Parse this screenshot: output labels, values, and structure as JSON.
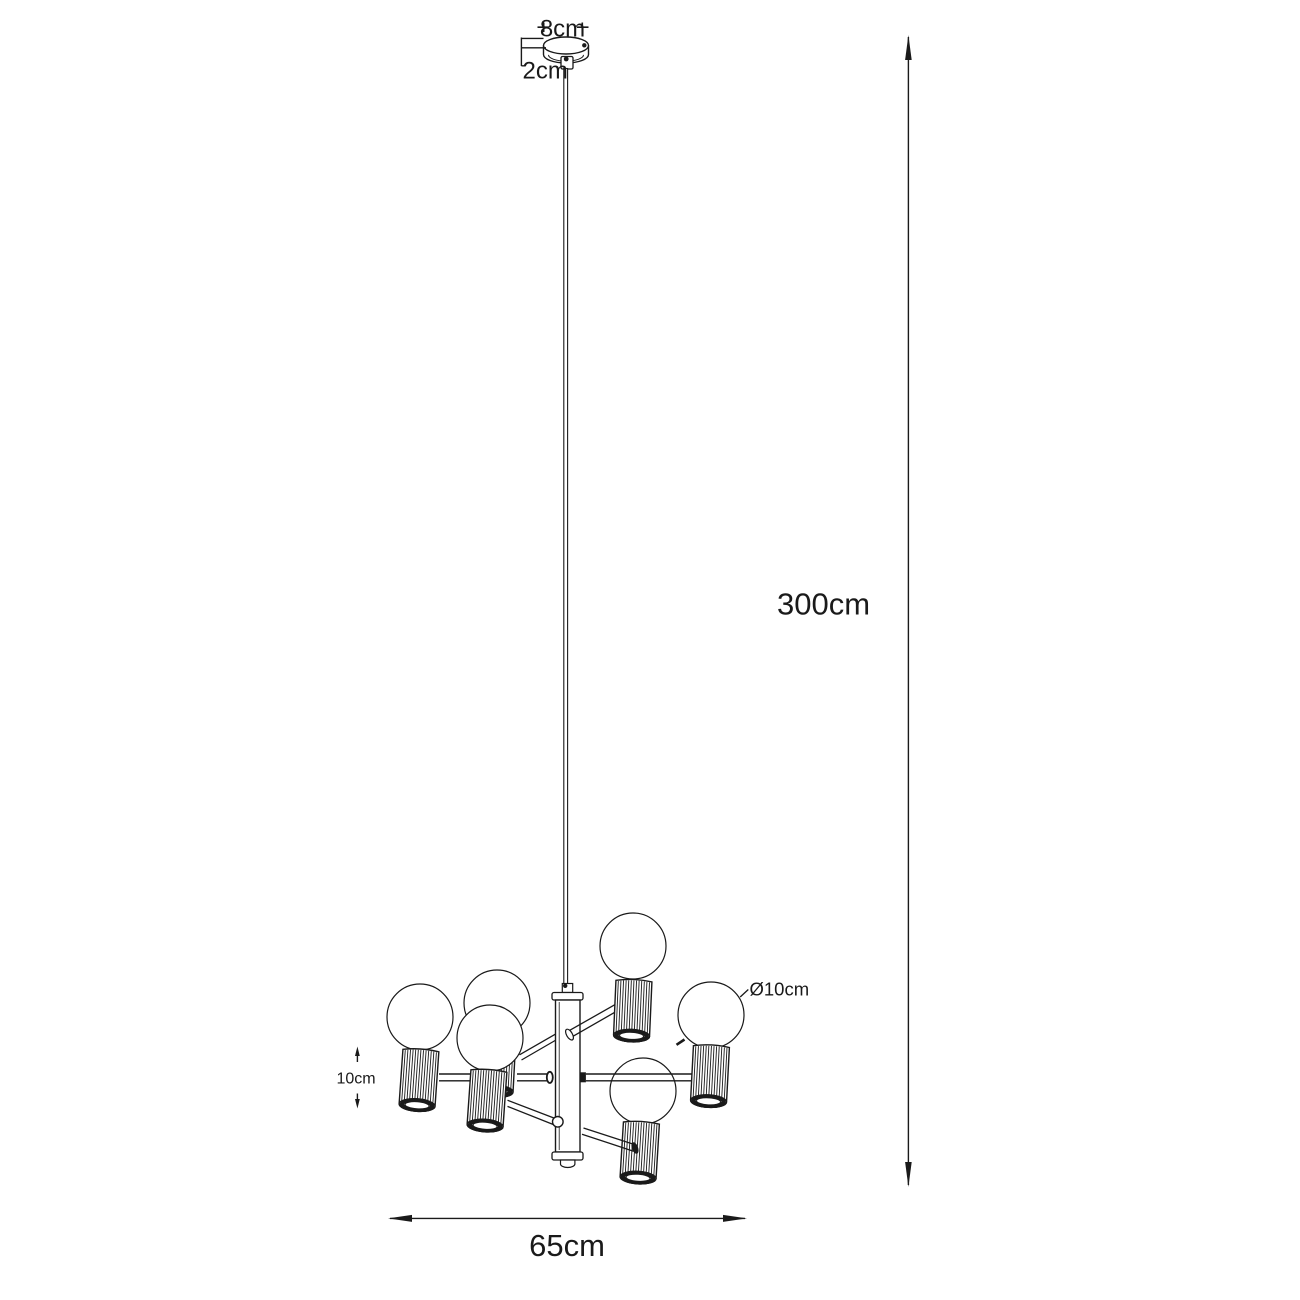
{
  "figure": {
    "kind": "technical-dimension-diagram",
    "subject": "pendant chandelier with 6 globe bulbs in ribbed cylinder shades",
    "bulb_count": 6
  },
  "labels": {
    "canopy_width": "8cm",
    "canopy_height": "2cm",
    "suspension_length": "300cm",
    "fixture_width": "65cm",
    "shade_height": "10cm",
    "bulb_diameter": "Ø10cm"
  },
  "colors": {
    "line": "#1a1a1a",
    "background": "#ffffff"
  }
}
